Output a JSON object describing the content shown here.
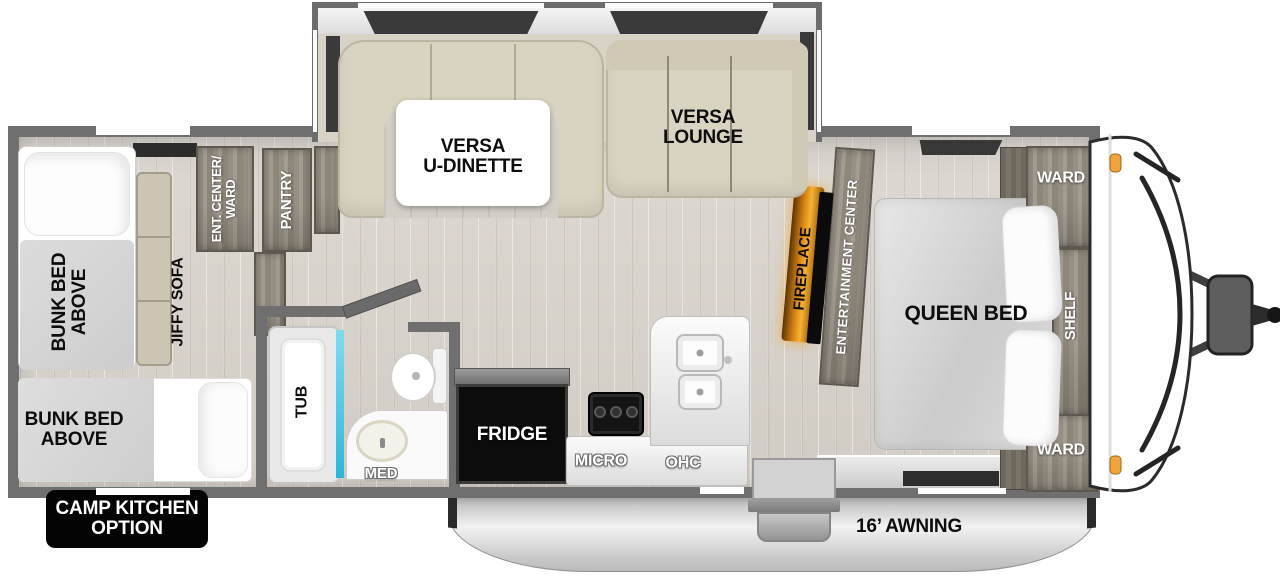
{
  "floorplan": {
    "slideout": {
      "dinette": "VERSA\nU-DINETTE",
      "lounge": "VERSA\nLOUNGE"
    },
    "rear_bedroom": {
      "bunk_top": "BUNK BED\nABOVE",
      "bunk_bottom": "BUNK BED\nABOVE",
      "sofa": "JIFFY SOFA",
      "ent_center_ward": "ENT. CENTER/\nWARD",
      "pantry": "PANTRY"
    },
    "bathroom": {
      "tub": "TUB",
      "med": "MED"
    },
    "kitchen": {
      "fridge": "FRIDGE",
      "micro": "MICRO",
      "ohc": "OHC"
    },
    "living": {
      "fireplace": "FIREPLACE",
      "entertainment_center": "ENTERTAINMENT CENTER"
    },
    "front_bedroom": {
      "queen_bed": "QUEEN BED",
      "ward_top": "WARD",
      "ward_bottom": "WARD",
      "shelf": "SHELF"
    },
    "exterior": {
      "awning": "16’ AWNING",
      "camp_kitchen_option": "CAMP KITCHEN\nOPTION"
    },
    "colors": {
      "wall_gray": "#6f6f6f",
      "floor_wood": "#d8d3cb",
      "cabinet_wood": "#948d82",
      "upholstery_beige": "#d9d3c1",
      "fireplace_glow": "#f7b231",
      "shower_glass": "#4ac9e8",
      "marker_light": "#f2a43c",
      "fridge_black": "#0c0c0c",
      "badge_black": "#040404",
      "awning_silver": "#d9d9d9"
    }
  }
}
